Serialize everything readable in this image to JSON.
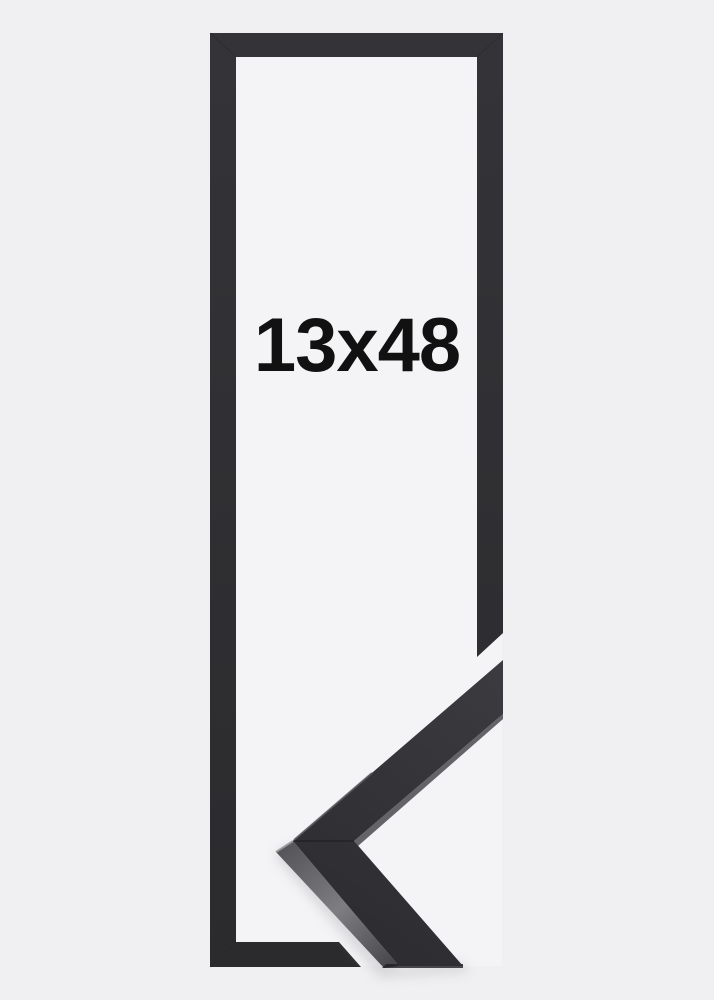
{
  "product": {
    "size_label": "13x48"
  },
  "colors": {
    "background": "#f0f0f2",
    "opening": "#f4f4f6",
    "frame_top": "#343438",
    "frame_bottom": "#2b2b2e",
    "corner_face_light": "#3b3b40",
    "corner_face_dark": "#2b2b2f",
    "corner_side_start": "#55555a",
    "corner_side_mid": "#7d7d82",
    "corner_side_end": "#444448",
    "edge_highlight": "#9a9a9f",
    "seam": "#1a1a1d",
    "shadow": "#bfbfc3",
    "label_text": "#111111"
  }
}
